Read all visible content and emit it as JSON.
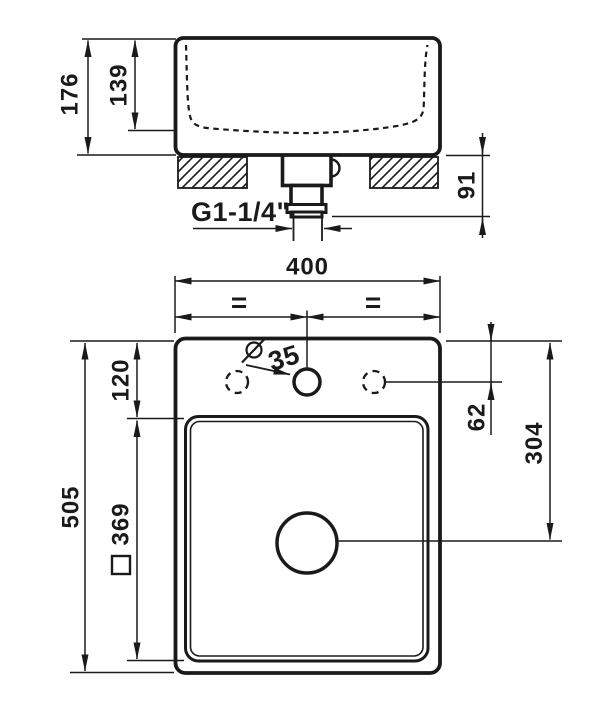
{
  "title": "Washbasin technical dimension drawing",
  "colors": {
    "background": "#ffffff",
    "line": "#1a1a1a"
  },
  "side_view": {
    "name": "front section view",
    "dims": {
      "total_height": "176",
      "basin_depth": "139",
      "drain_height": "91",
      "drain_thread": "G1-1/4\""
    }
  },
  "plan_view": {
    "name": "top view",
    "dims": {
      "overall_width": "400",
      "equal_left": "=",
      "equal_right": "=",
      "faucet_hole_symbol": "⌀",
      "faucet_hole_dia": "35",
      "edge_to_faucet": "62",
      "overall_depth": "505",
      "edge_to_basin": "120",
      "basin_square_symbol": "□",
      "basin_size": "369",
      "edge_to_drain": "304"
    }
  }
}
